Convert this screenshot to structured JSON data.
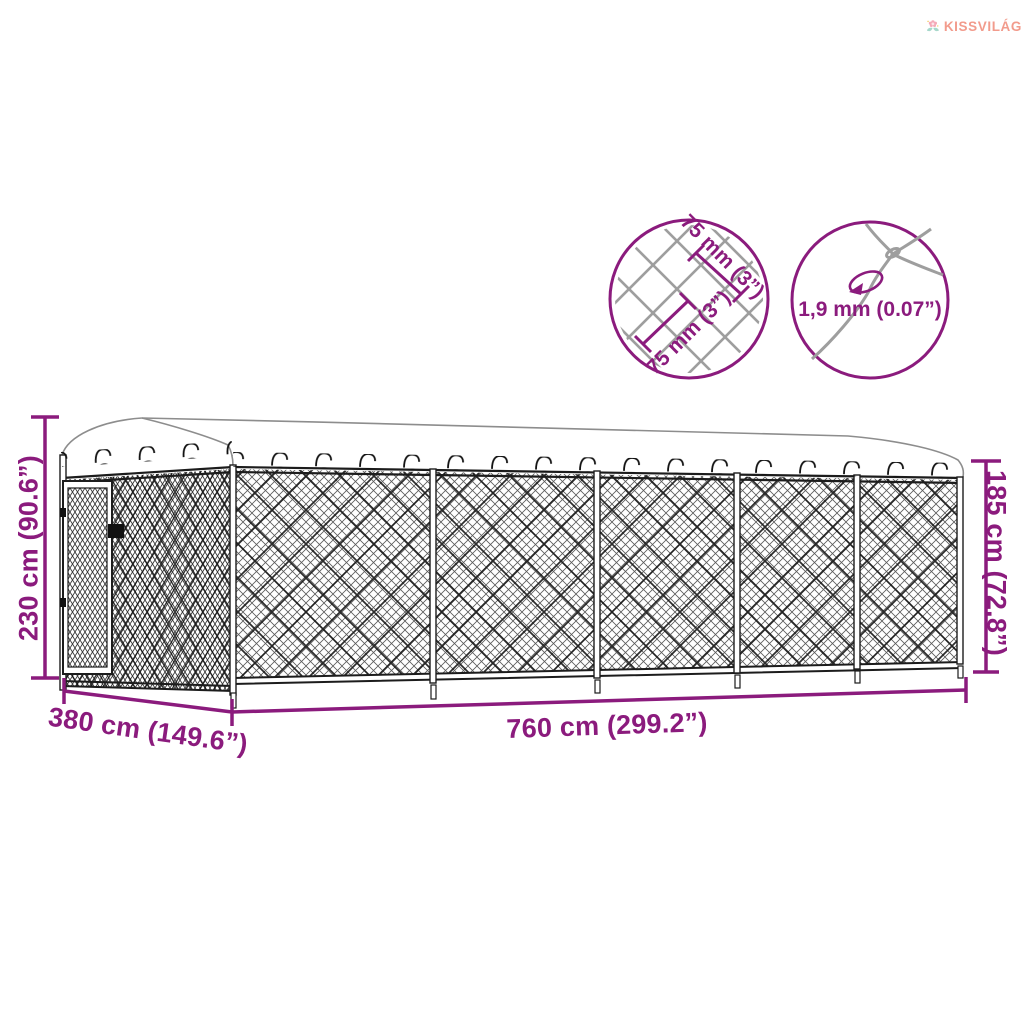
{
  "brand": {
    "name": "KISSVILÁG"
  },
  "dimensions": {
    "total_height": "230 cm (90.6”)",
    "depth": "380 cm (149.6”)",
    "length": "760 cm (299.2”)",
    "side_height": "185 cm (72.8”)"
  },
  "mesh_details": {
    "opening_a": "75 mm (3”)",
    "opening_b": "75 mm (3”)",
    "wire_diameter": "1,9 mm (0.07”)"
  },
  "colors": {
    "dimension_purple": "#8B1B7D",
    "wire_gray": "#9E9E9E",
    "fence_dark": "#1C1C1C",
    "canopy_outline": "#8D8D8D",
    "logo_text": "#F29B8C",
    "logo_petal": "#F5A9B8",
    "logo_leaf": "#A7D8CB",
    "logo_accent": "#F7CE6B"
  }
}
